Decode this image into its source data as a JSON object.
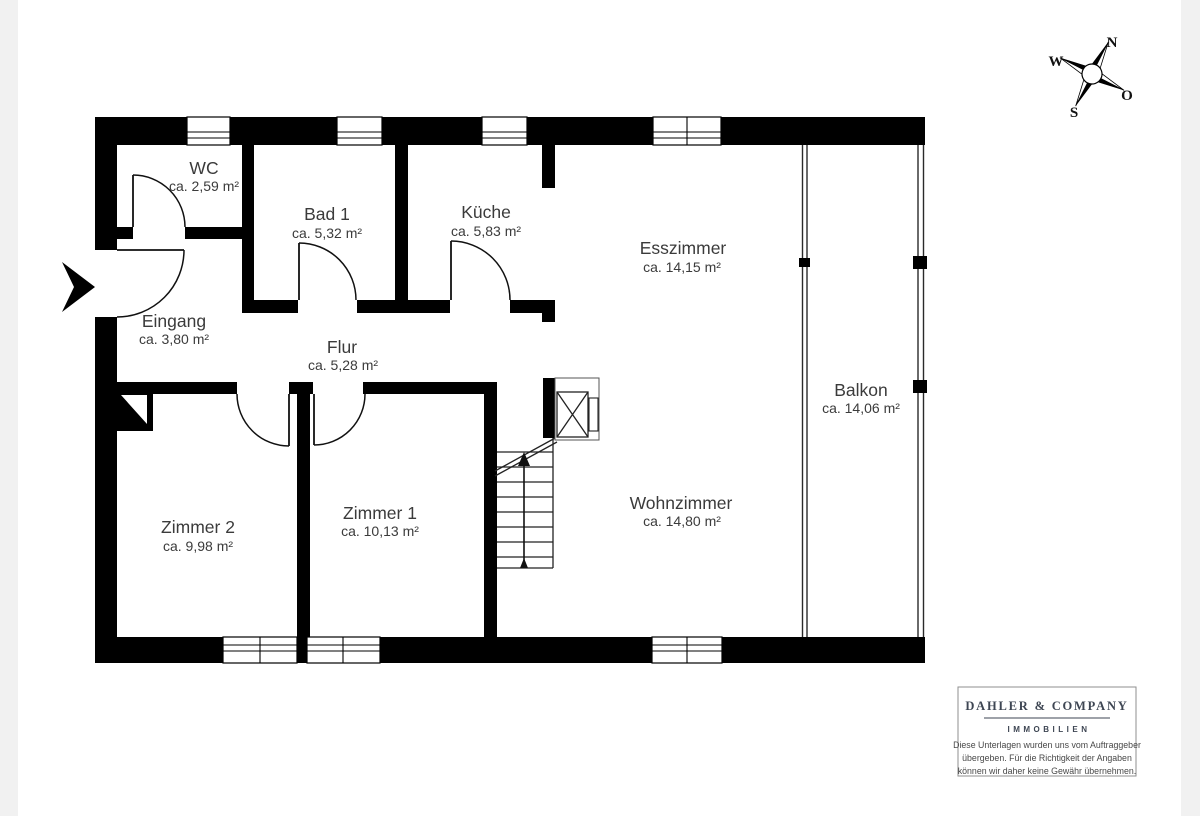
{
  "page": {
    "background": "#ffffff",
    "margin_color": "#f1f1f1"
  },
  "colors": {
    "wall": "#000000",
    "room_label": "#3b3b3b",
    "logo_text": "#3e4653",
    "disclaimer_text": "#484848",
    "box_border": "#8f8f8f"
  },
  "compass": {
    "north": "N",
    "east": "O",
    "south": "S",
    "west": "W"
  },
  "rooms": [
    {
      "name": "WC",
      "area": "ca. 2,59 m²"
    },
    {
      "name": "Bad 1",
      "area": "ca. 5,32 m²"
    },
    {
      "name": "Küche",
      "area": "ca. 5,83 m²"
    },
    {
      "name": "Esszimmer",
      "area": "ca. 14,15 m²"
    },
    {
      "name": "Eingang",
      "area": "ca. 3,80 m²"
    },
    {
      "name": "Flur",
      "area": "ca. 5,28 m²"
    },
    {
      "name": "Zimmer 2",
      "area": "ca. 9,98 m²"
    },
    {
      "name": "Zimmer 1",
      "area": "ca. 10,13 m²"
    },
    {
      "name": "Wohnzimmer",
      "area": "ca. 14,80 m²"
    },
    {
      "name": "Balkon",
      "area": "ca. 14,06 m²"
    }
  ],
  "branding": {
    "company": "DAHLER & COMPANY",
    "division": "IMMOBILIEN",
    "disclaimer": [
      "Diese Unterlagen wurden uns vom Auftraggeber",
      "übergeben. Für die Richtigkeit der Angaben",
      "können wir daher keine Gewähr übernehmen."
    ]
  }
}
